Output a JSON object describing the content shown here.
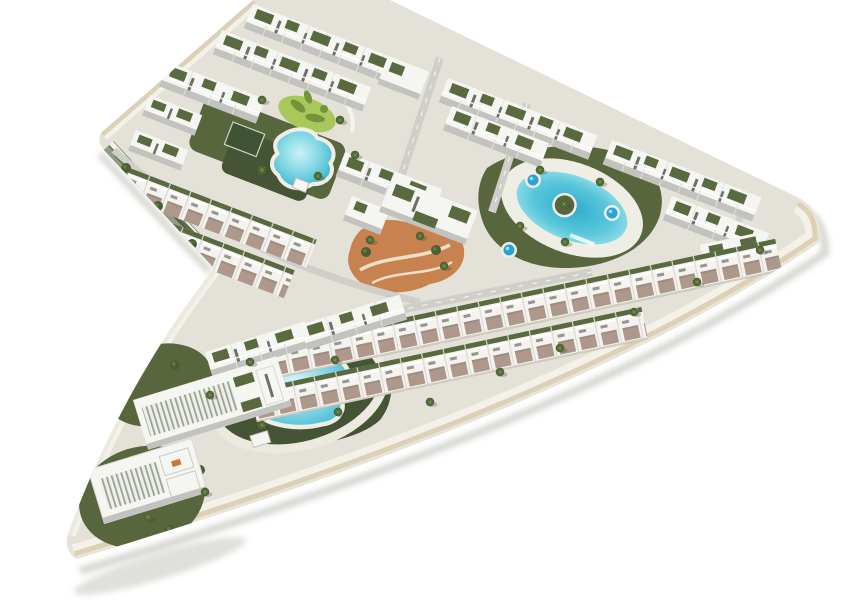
{
  "meta": {
    "kind": "aerial-3d-architectural-render",
    "canvas": {
      "width": 850,
      "height": 614
    },
    "site_shape": "chevron of two wings meeting at a rounded right-hand tip on a white background"
  },
  "palette": {
    "background": "#ffffff",
    "site-base": "#e4e2d8",
    "path-light": "#eceade",
    "road-grey": "#cfcec8",
    "road-cream": "#dcd1b8",
    "curb-white": "#f3f1e8",
    "wall-sage": "#8e9c83",
    "wall-sage-dark": "#5f6e54",
    "building-white": "#f5f5f2",
    "building-shade": "#c2c2be",
    "building-dark": "#6e6e6a",
    "roof-garden": "#5a6a40",
    "lawn-olive": "#57663d",
    "lawn-deep": "#455435",
    "lime-green": "#a9c85c",
    "lime-dark": "#74943c",
    "pool-turquoise": "#57c6d8",
    "pool-light": "#a5e4ec",
    "pool-deep": "#2aa3d4",
    "deck-white": "#efeee5",
    "patio-mauve": "#ad988b",
    "hedge-green": "#4f5f38",
    "terracotta": "#c8824f",
    "terracotta-path": "#ecdfca",
    "palm-green": "#435830",
    "palm-light": "#637c3e",
    "court-dark": "#3f5233",
    "shadow": "rgba(110,108,96,0.28)"
  },
  "scene": {
    "labels": {
      "site": "Aerial render of residential development masterplan",
      "upper_wing": "Upper wing of apartment and townhouse rows",
      "lower_wing": "Lower wing with pool gardens and tip building",
      "lagoon_pool": "Free-form lagoon pool",
      "leisure_green": "Lime leisure putting green",
      "sport_court": "Dark green sport court",
      "oval_pool": "Oval pool with central palm island",
      "spa_pool": "Round spa pool",
      "lower_pool": "Free-form garden pool with loop path",
      "terracotta_garden": "Terracotta landscaped garden with curved paths",
      "apartment_row": "White apartment row with roof gardens",
      "townhouse_row": "Townhouse row with mauve patios",
      "tip_building": "Louvred apartment building at the tip",
      "retaining_wall": "Sage retaining wall edge",
      "perimeter_road": "Cream perimeter road with white curb",
      "palm_tree": "Palm tree",
      "bush": "Garden bush"
    },
    "counts": {
      "spa_pools": 3,
      "large_pools": 3,
      "courtyards": 3
    }
  }
}
